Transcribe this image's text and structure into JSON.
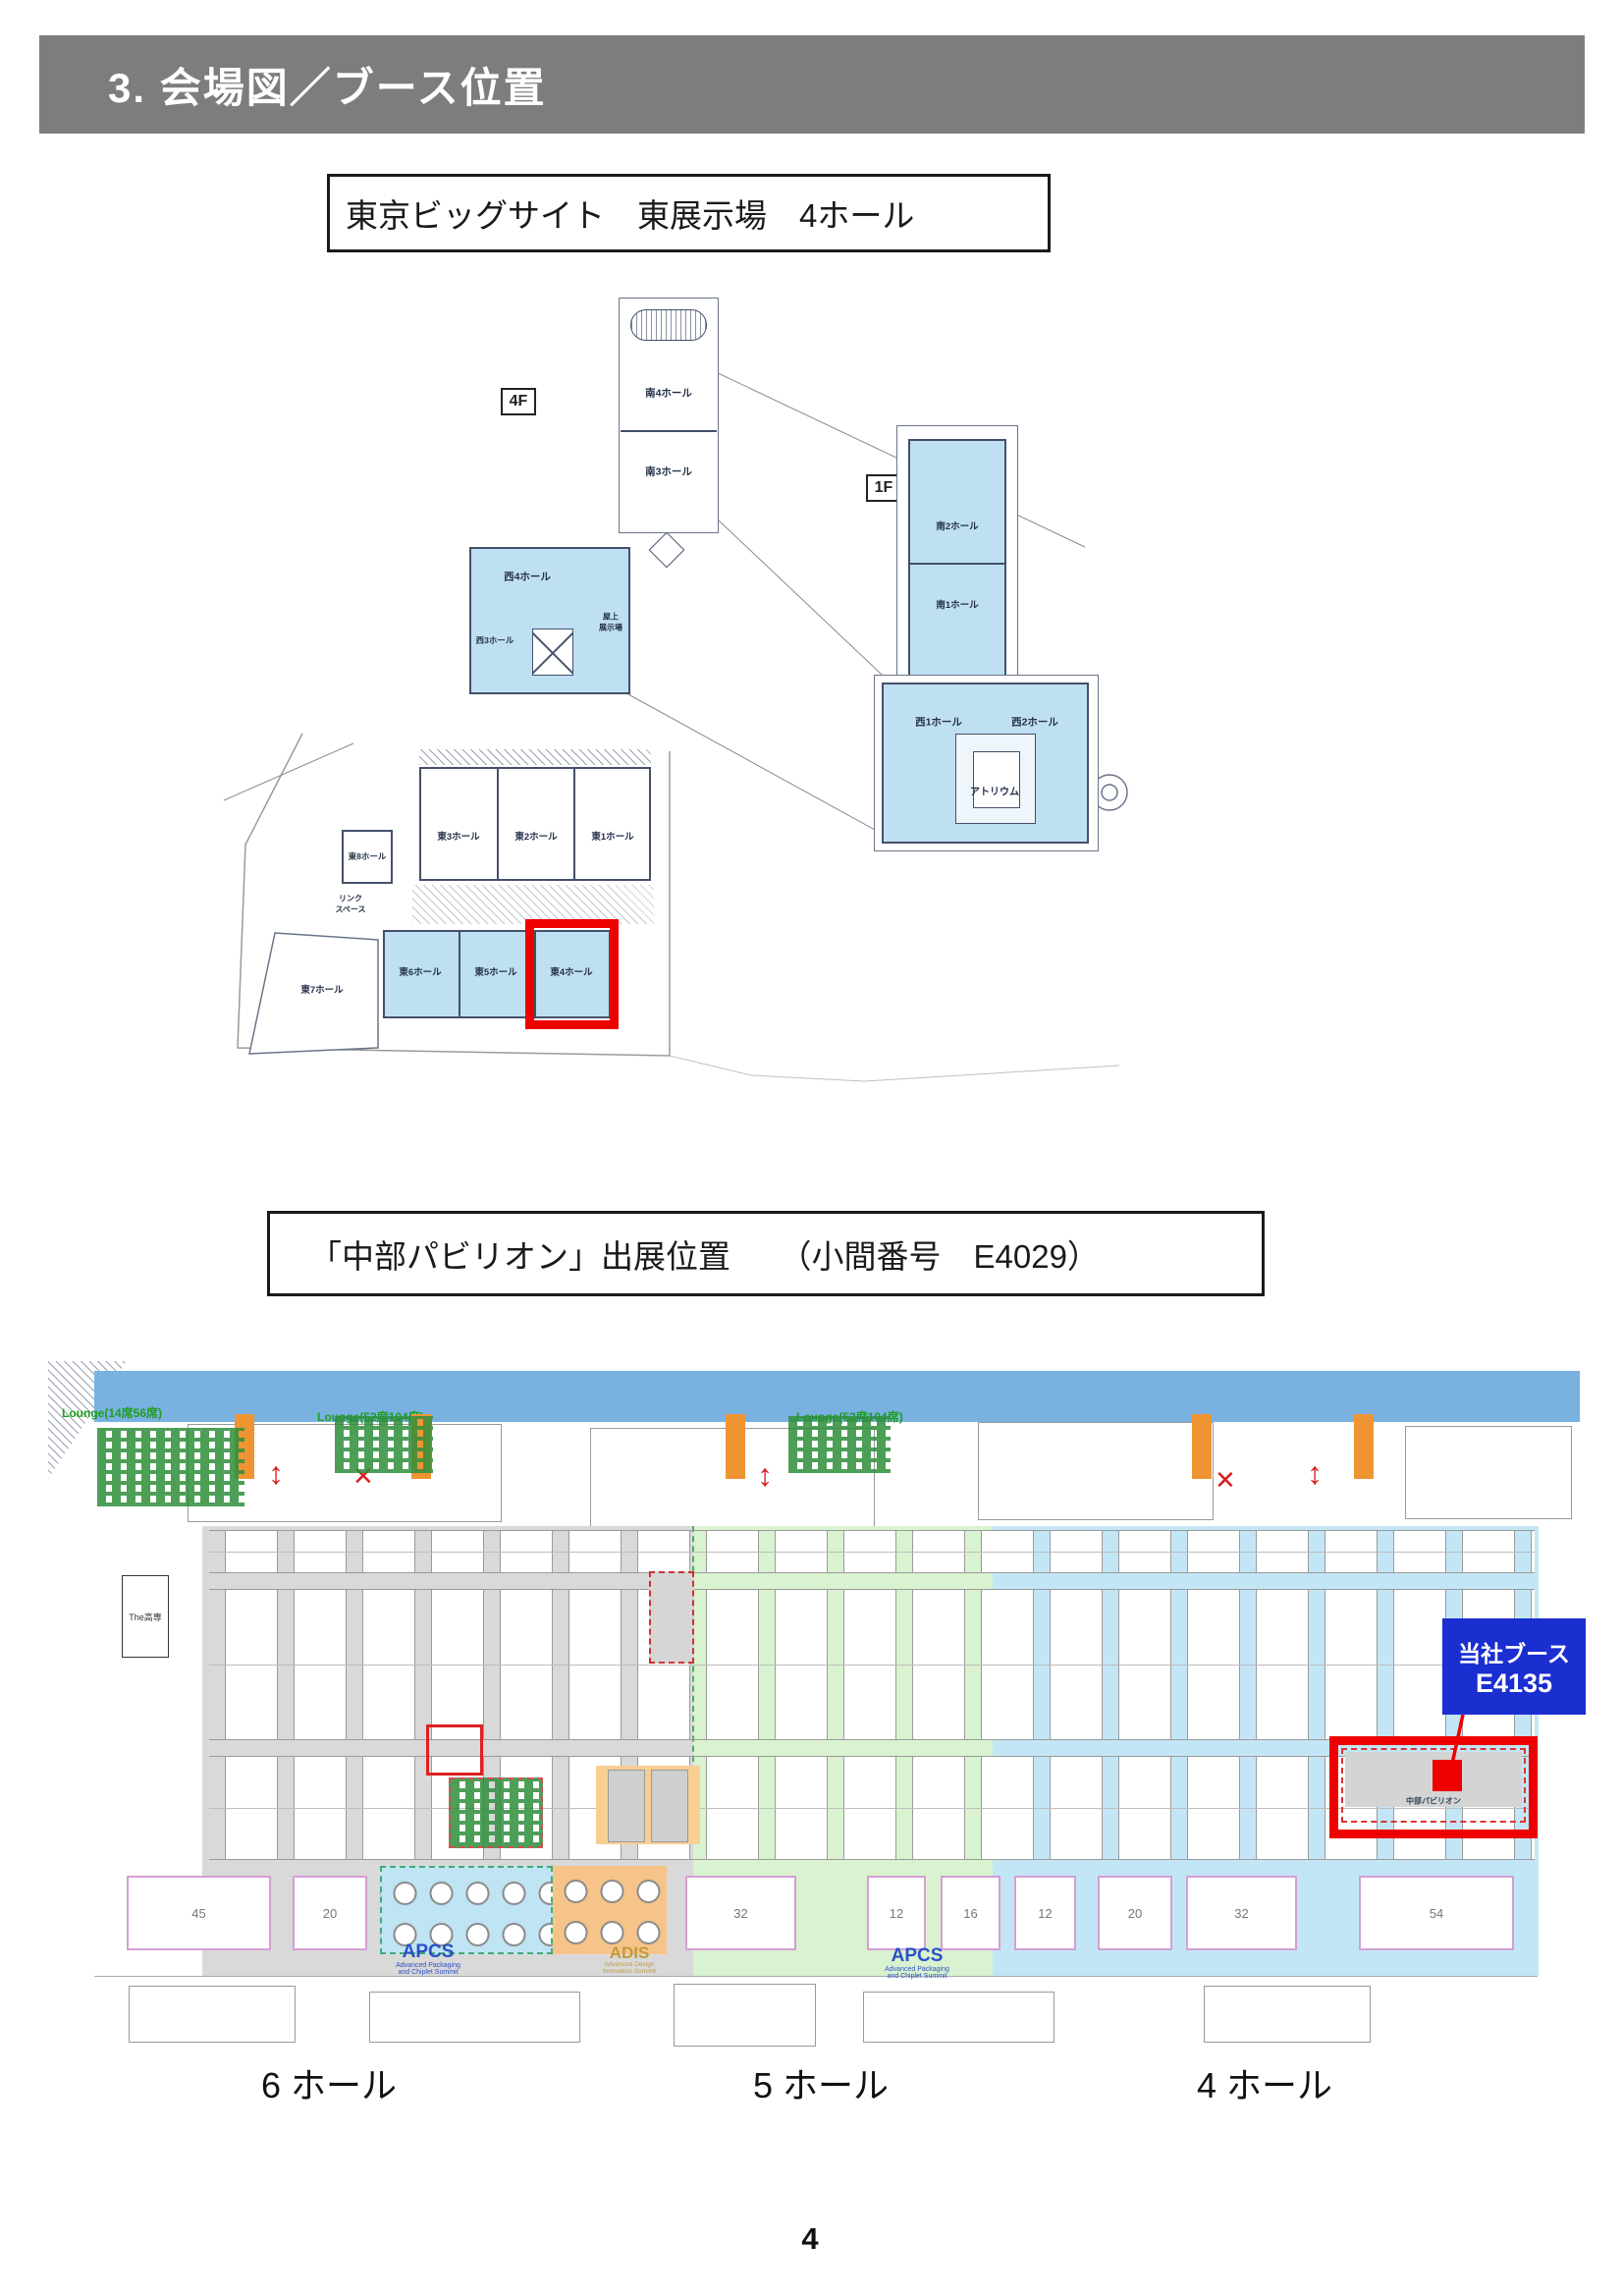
{
  "header": {
    "title": "3. 会場図／ブース位置"
  },
  "title_boxes": {
    "venue": "東京ビッグサイト　東展示場　4ホール",
    "booth": "「中部パビリオン」出展位置　　（小間番号　E4029）"
  },
  "venue_map": {
    "floor_4f": "4F",
    "floor_1f": "1F",
    "halls": {
      "minami4": "南4ホール",
      "minami3": "南3ホール",
      "minami2": "南2ホール",
      "minami1": "南1ホール",
      "nishi4": "西4ホール",
      "nishi3": "西3ホール",
      "rooftop_line1": "屋上",
      "rooftop_line2": "展示場",
      "nishi1": "西1ホール",
      "nishi2": "西2ホール",
      "atrium": "アトリウム",
      "higashi1": "東1ホール",
      "higashi2": "東2ホール",
      "higashi3": "東3ホール",
      "higashi4": "東4ホール",
      "higashi5": "東5ホール",
      "higashi6": "東6ホール",
      "higashi7": "東7ホール",
      "higashi8": "東8ホール",
      "link_line1": "リンク",
      "link_line2": "スペース"
    }
  },
  "floor_plan": {
    "lounge_left": "Lounge(14席56席)",
    "lounge_mid": "Lounge(52席104席)",
    "lounge_right": "Lounge(52席104席)",
    "kosen_label": "The高専",
    "pavilion_label": "中部パビリオン",
    "callout": {
      "line1": "当社ブース",
      "line2": "E4135"
    },
    "apcs": {
      "name": "APCS",
      "sub1": "Advanced Packaging",
      "sub2": "and Chiplet Summit"
    },
    "adis": {
      "name": "ADIS",
      "sub1": "Advanced Design",
      "sub2": "Innovation Summit"
    },
    "x_mark": "✕",
    "arrow_mark": "↕",
    "bottom_booths": [
      "45",
      "20",
      "32",
      "12",
      "16",
      "12",
      "20",
      "32",
      "54"
    ],
    "hall_labels": [
      "6 ホール",
      "5 ホール",
      "4 ホール"
    ]
  },
  "page_number": "4",
  "colors": {
    "header_gray": "#7d7d7d",
    "hall_blue": "#bfe0f2",
    "highlight_red": "#ee0000",
    "callout_blue": "#1b2ed0",
    "zone_gray": "#d9d9d9",
    "zone_green": "#d9f2cf",
    "zone_blue": "#c3e6f6",
    "pillar_orange": "#ef9433",
    "band_blue": "#79b1e1",
    "apcs_blue": "#2b50c8",
    "adis_gold": "#c09a3e"
  }
}
